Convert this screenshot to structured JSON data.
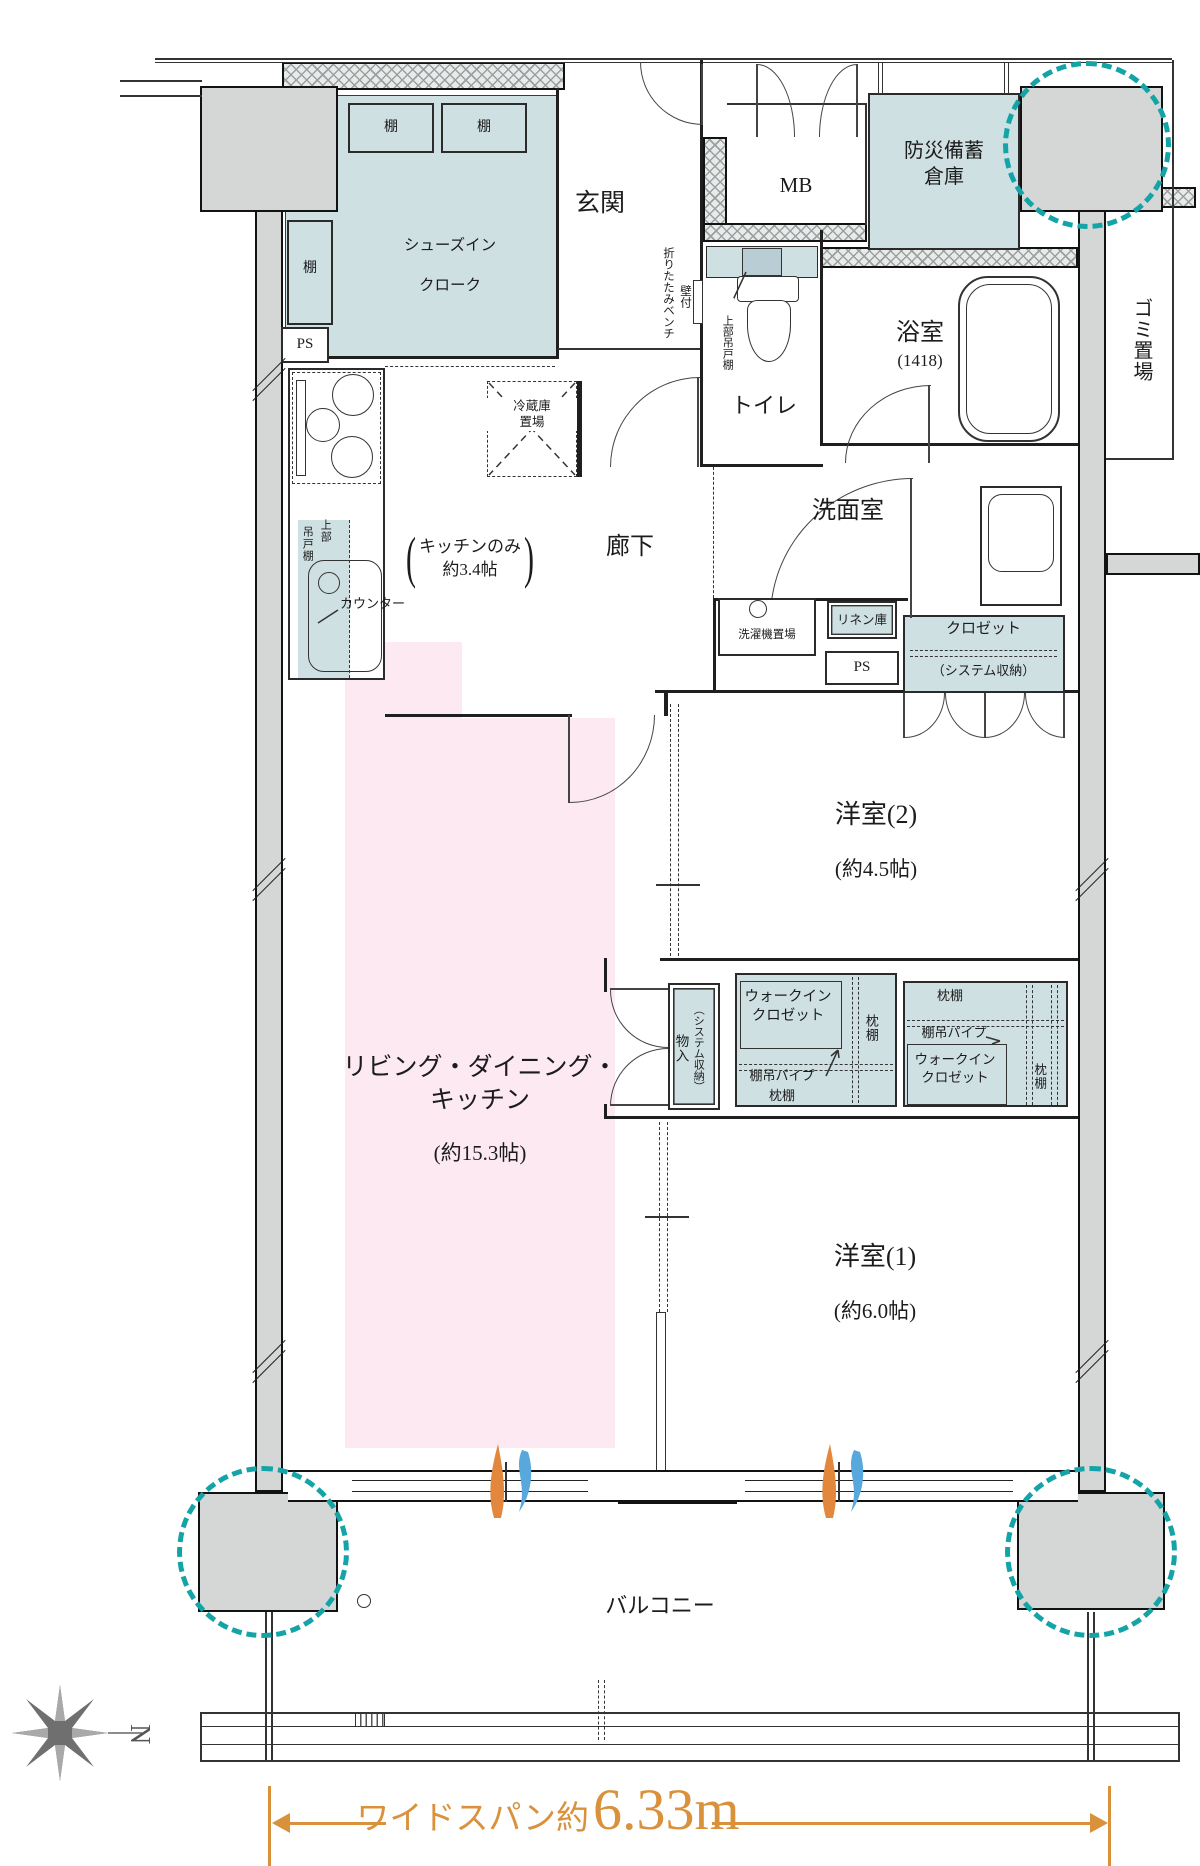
{
  "colors": {
    "room_blue": "#cfe0e3",
    "ldk_pink": "#fce9f2",
    "wall_gray": "#d5d7d7",
    "pillar_highlight_teal": "#14a3a6",
    "dimension_orange": "#d9913b"
  },
  "rooms": {
    "sic": {
      "line1": "シューズイン",
      "line2": "クローク"
    },
    "genkan": {
      "name": "玄関"
    },
    "mb": {
      "name": "MB"
    },
    "disaster_storage": {
      "line1": "防災備蓄",
      "line2": "倉庫"
    },
    "garbage": {
      "name": "ゴミ置場"
    },
    "bathroom": {
      "name": "浴室",
      "size": "(1418)"
    },
    "toilet": {
      "name": "トイレ"
    },
    "washroom": {
      "name": "洗面室"
    },
    "corridor": {
      "name": "廊下"
    },
    "kitchen": {
      "paren_open": "(",
      "line1": "キッチンのみ",
      "line2": "約3.4帖",
      "paren_close": ")"
    },
    "ldk": {
      "line1": "リビング・ダイニング・",
      "line2": "キッチン",
      "size": "(約15.3帖)"
    },
    "bedroom2": {
      "name": "洋室(2)",
      "size": "(約4.5帖)"
    },
    "bedroom1": {
      "name": "洋室(1)",
      "size": "(約6.0帖)"
    },
    "balcony": {
      "name": "バルコニー"
    }
  },
  "fixtures": {
    "shelf": "棚",
    "ps": "PS",
    "bench": "折りたたみベンチ",
    "bench_mount": "壁付",
    "toilet_upper_shelf": "上部吊戸棚",
    "fridge_line1": "冷蔵庫",
    "fridge_line2": "置場",
    "hanging_upper": "上部",
    "hanging_shelf": "吊戸棚",
    "counter": "カウンター",
    "washer": "洗濯機置場",
    "linen": "リネン庫",
    "closet": "クロゼット",
    "closet_type": "（システム収納）",
    "storage": "物入",
    "storage_type": "（システム収納）",
    "wic_line1": "ウォークイン",
    "wic_line2": "クロゼット",
    "pillow_shelf": "枕棚",
    "hanger_pipe": "棚吊パイプ"
  },
  "dimension": {
    "label": "ワイドスパン約",
    "value": "6.33m"
  },
  "compass": {
    "north": "N"
  }
}
